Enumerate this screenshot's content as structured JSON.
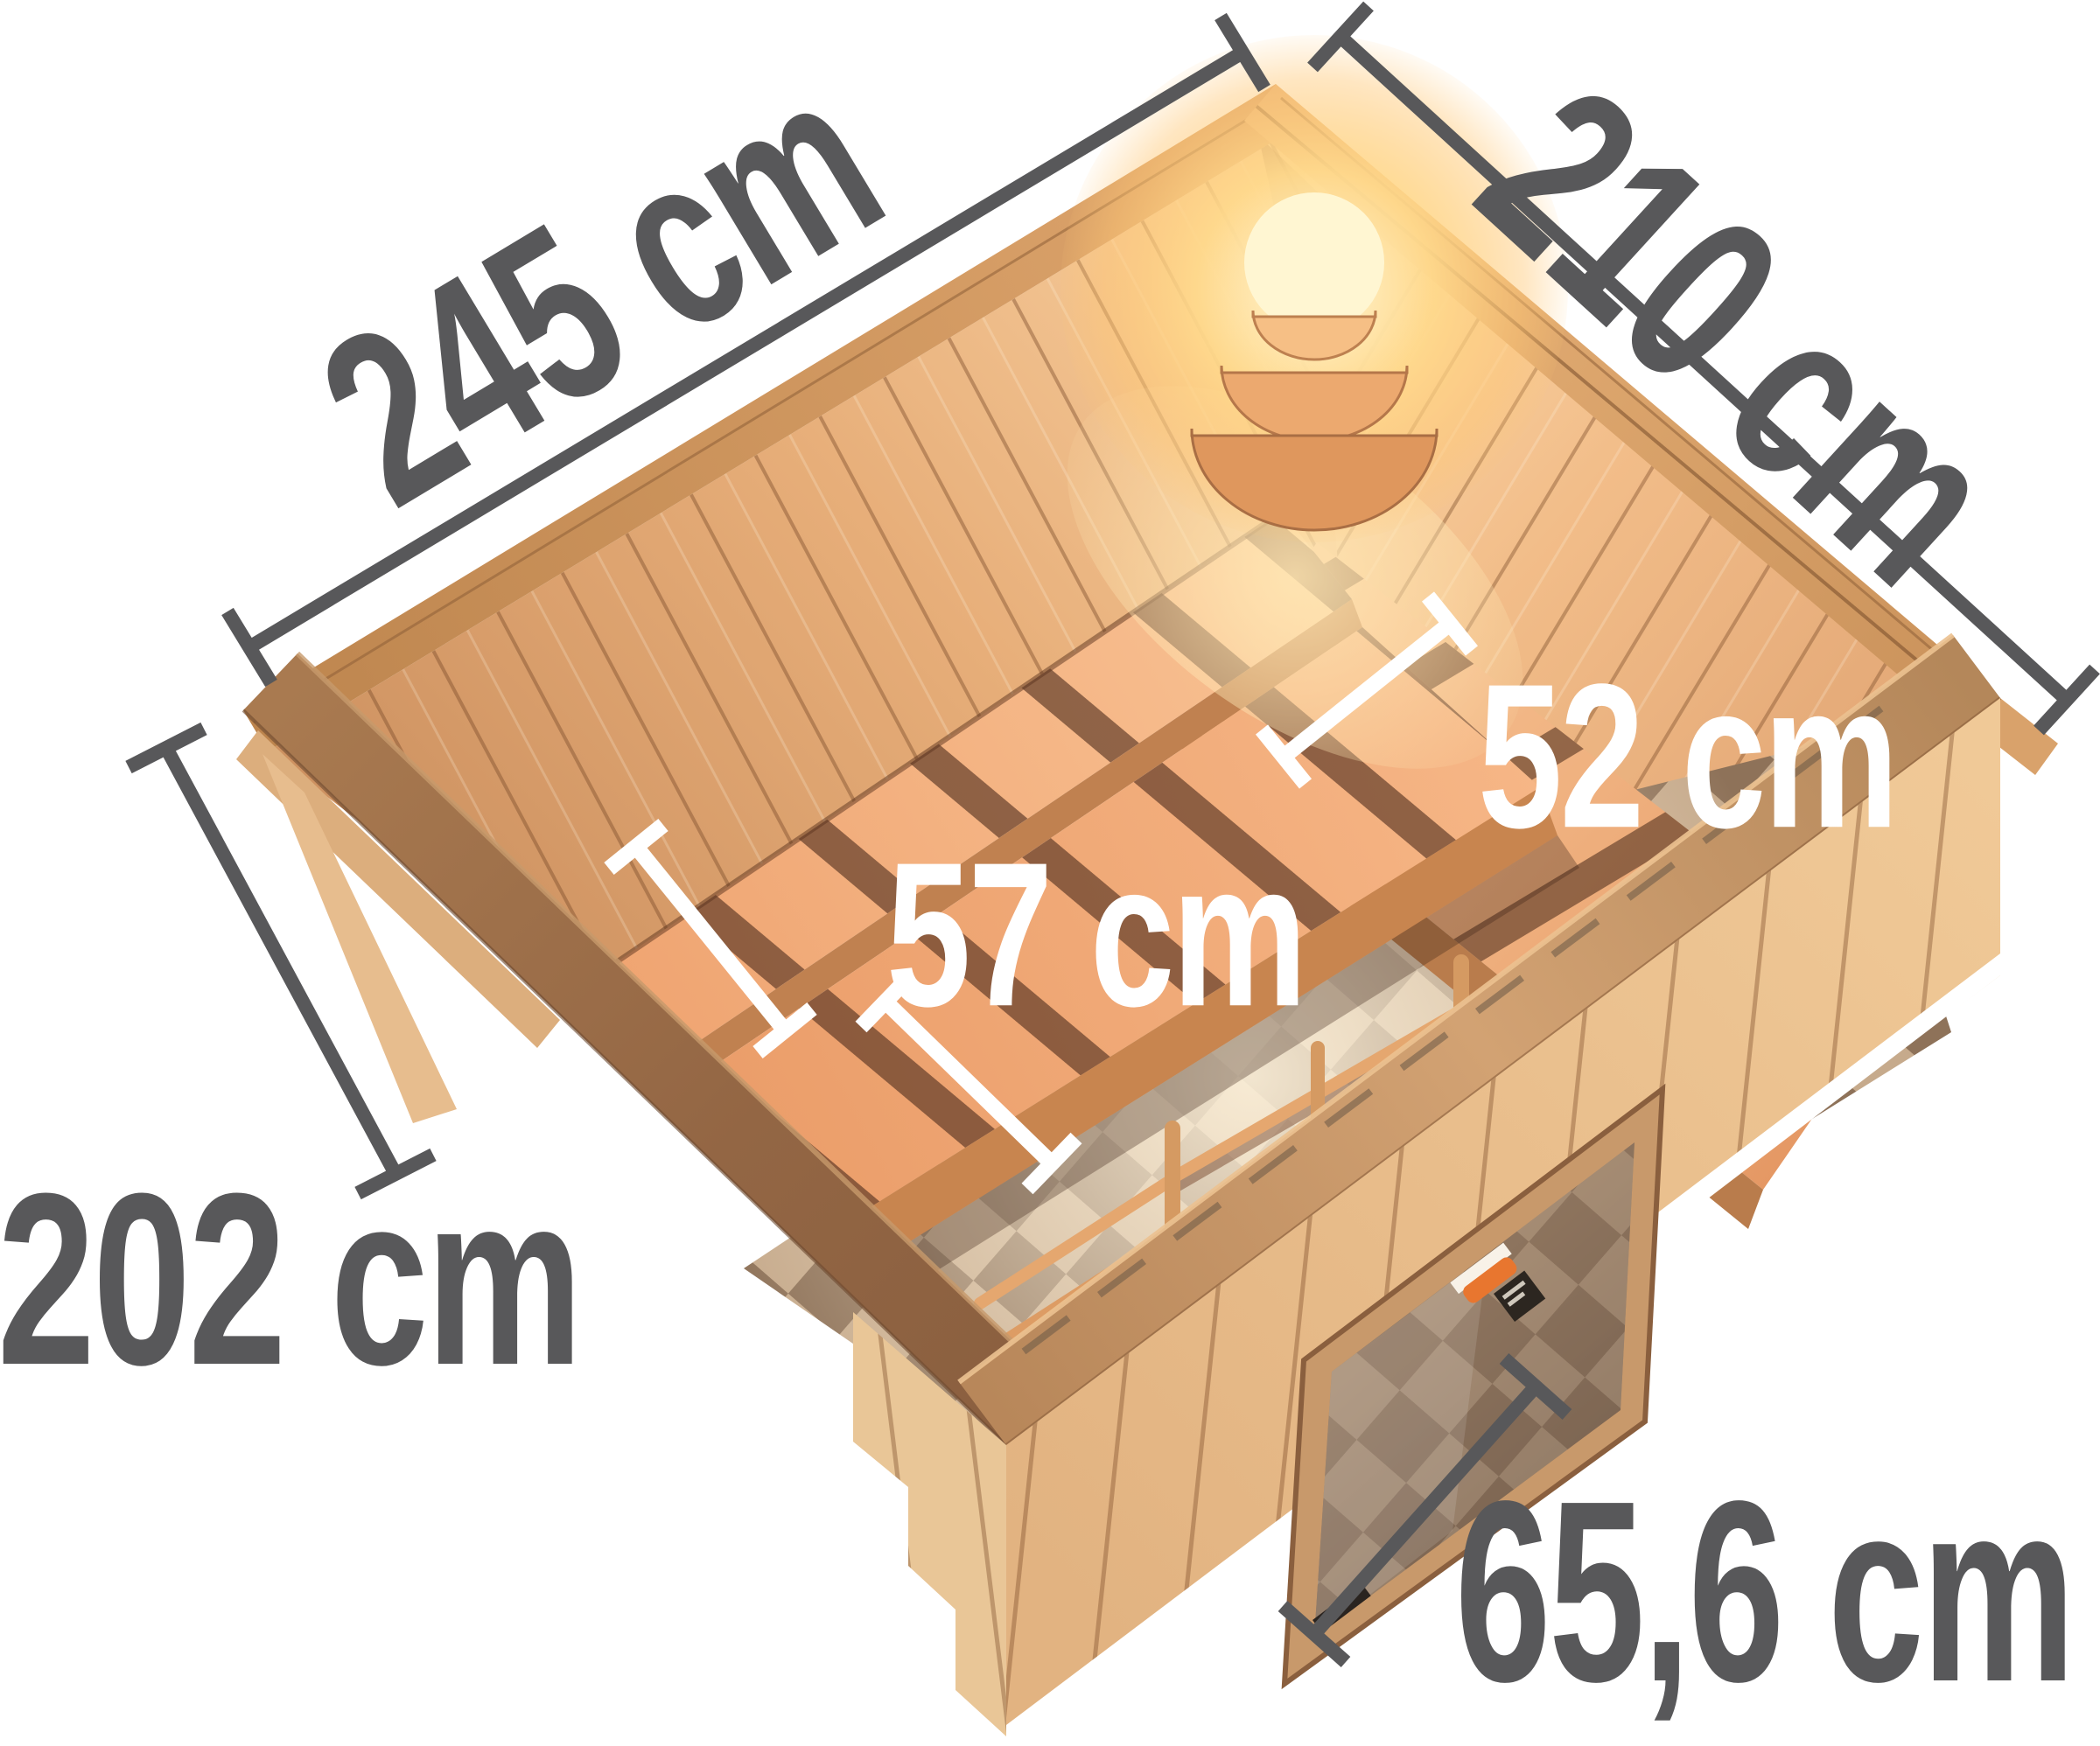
{
  "diagram": {
    "type": "product-dimension-diagram",
    "subject": "wooden sauna cabin, top perspective view with interior benches, corner lamp, checkered floor and glass door",
    "labels": {
      "width": "245 cm",
      "depth": "210 cm",
      "height": "202 cm",
      "bench_upper": "52 cm",
      "bench_lower": "57 cm",
      "door_width": "65,6 cm"
    },
    "colors": {
      "dimension_text": "#58585a",
      "dimension_line": "#58585a",
      "interior_dimension": "#ffffff",
      "wood_light": "#f2c796",
      "wood_mid": "#dfa471",
      "wood_dark": "#96693f",
      "floor_check_light": "#c6aa8c",
      "floor_check_dark": "#8e7259",
      "lamp_glow": "#ffd98c",
      "background": "#ffffff"
    }
  }
}
